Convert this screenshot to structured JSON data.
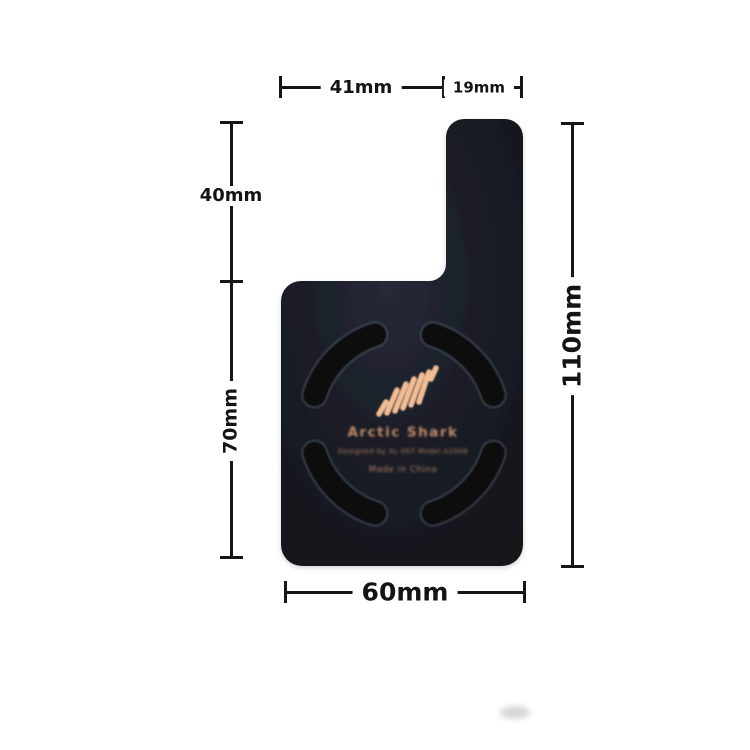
{
  "page": {
    "background": "#ffffff",
    "type": "product-dimension-diagram"
  },
  "dimensions": {
    "top_width_left": "41mm",
    "top_width_right": "19mm",
    "left_height_upper": "40mm",
    "left_height_lower": "70mm",
    "right_height_total": "110mm",
    "bottom_width_total": "60mm"
  },
  "product": {
    "brand": "Arctic Shark",
    "subtitle": "Designed by XL 007 Model A2008",
    "origin": "Made in China",
    "colors": {
      "body": "#1b1e27",
      "slot": "#0a0c11",
      "slot_rim": "#5a6170",
      "logo_stripes": "#f2bd94",
      "engraved_text": "#bf8c69",
      "dimension_lines": "#161616"
    }
  },
  "icons": {
    "logo": "shark-fin-stripes-icon"
  }
}
